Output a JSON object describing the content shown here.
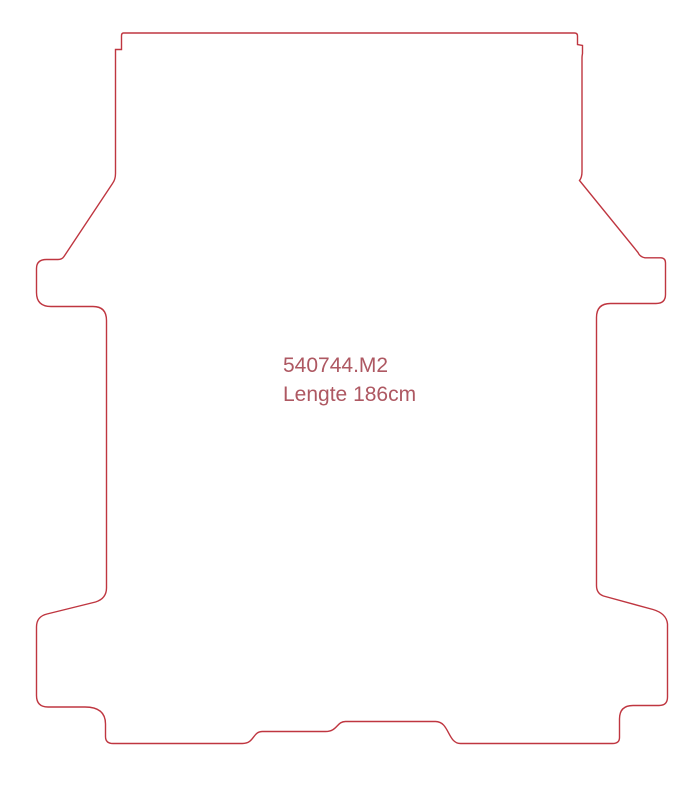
{
  "label": {
    "part_number": "540744.M2",
    "length": "Lengte 186cm"
  },
  "colors": {
    "outline": "#bf3640",
    "text": "#ae5862",
    "background": "#ffffff"
  }
}
